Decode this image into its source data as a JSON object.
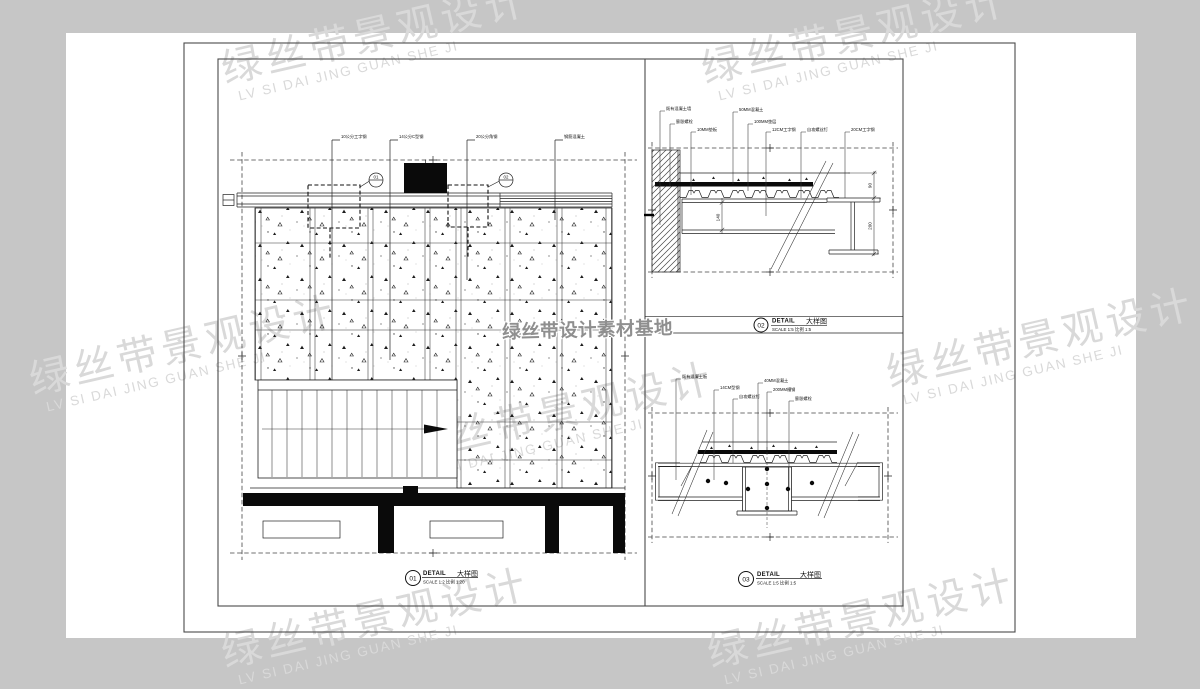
{
  "page": {
    "background": "#c6c6c6",
    "sheet_background": "#ffffff"
  },
  "watermark": {
    "line1": "绿丝带景观设计",
    "line2": "LV SI DAI JING GUAN SHE JI",
    "center": "绿丝带设计素材基地",
    "color": "#d9d9d9",
    "center_color": "#8f8f8f"
  },
  "titles": {
    "d01": {
      "num": "01",
      "label": "DETAIL",
      "label_cn": "大样图",
      "scale": "SCALE 1:2",
      "scale_cn": "比例 1:20"
    },
    "d02": {
      "num": "02",
      "label": "DETAIL",
      "label_cn": "大样图",
      "scale": "SCALE 1:5",
      "scale_cn": "比例 1:5"
    },
    "d03": {
      "num": "03",
      "label": "DETAIL",
      "label_cn": "大样图",
      "scale": "SCALE 1:5",
      "scale_cn": "比例 1:5"
    }
  },
  "d01": {
    "labels": [
      "10公分工字钢",
      "14公分C型钢",
      "20公分角钢",
      "钢筋混凝土"
    ],
    "callouts": [
      "01",
      "02"
    ]
  },
  "d02": {
    "labels": [
      "既有混凝土墙",
      "膨胀螺栓",
      "10MM垫板",
      "50MM混凝土",
      "100MM垫层",
      "12CM工字钢",
      "自攻螺丝钉",
      "20CM工字钢"
    ],
    "dims": [
      "140",
      "90",
      "200"
    ]
  },
  "d03": {
    "labels": [
      "既有混凝土板",
      "14CM型钢",
      "自攻螺丝钉",
      "40MM混凝土",
      "200MM槽钢",
      "膨胀螺栓"
    ]
  }
}
